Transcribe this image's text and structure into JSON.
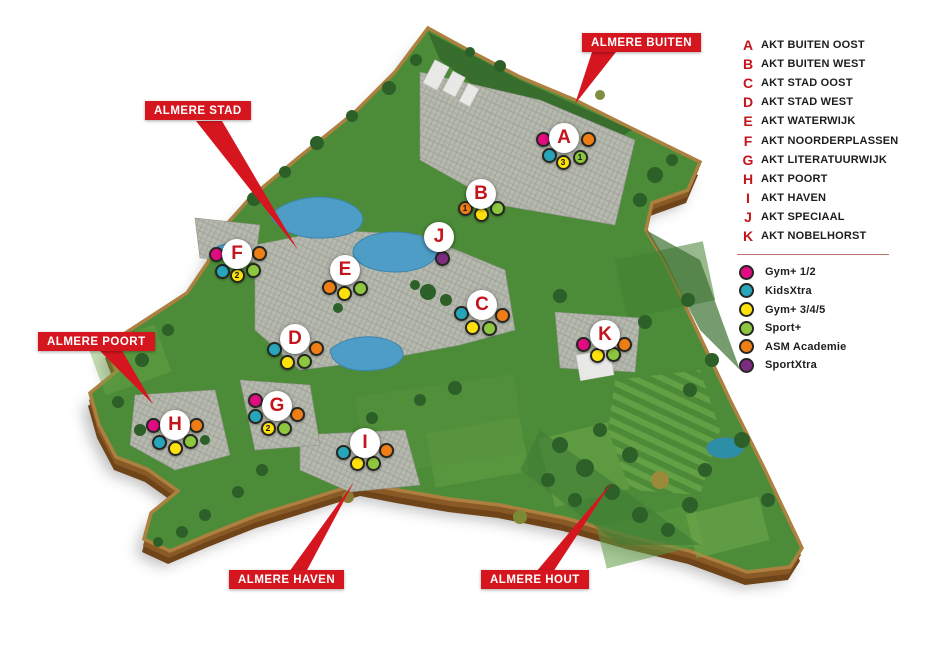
{
  "legend": {
    "districts": [
      {
        "letter": "A",
        "label": "AKT BUITEN OOST"
      },
      {
        "letter": "B",
        "label": "AKT BUITEN WEST"
      },
      {
        "letter": "C",
        "label": "AKT STAD OOST"
      },
      {
        "letter": "D",
        "label": "AKT STAD WEST"
      },
      {
        "letter": "E",
        "label": "AKT WATERWIJK"
      },
      {
        "letter": "F",
        "label": "AKT NOORDERPLASSEN"
      },
      {
        "letter": "G",
        "label": "AKT LITERATUURWIJK"
      },
      {
        "letter": "H",
        "label": "AKT POORT"
      },
      {
        "letter": "I",
        "label": "AKT HAVEN"
      },
      {
        "letter": "J",
        "label": "AKT SPECIAAL"
      },
      {
        "letter": "K",
        "label": "AKT NOBELHORST"
      }
    ],
    "programs": [
      {
        "key": "magenta",
        "name": "Gym+ 1/2",
        "color": "#e10b82"
      },
      {
        "key": "cyan",
        "name": "KidsXtra",
        "color": "#27a5bb"
      },
      {
        "key": "yellow",
        "name": "Gym+ 3/4/5",
        "color": "#ffe20c"
      },
      {
        "key": "green",
        "name": "Sport+",
        "color": "#8dc63f"
      },
      {
        "key": "orange",
        "name": "ASM Academie",
        "color": "#f07e16"
      },
      {
        "key": "purple",
        "name": "SportXtra",
        "color": "#7d2c82"
      }
    ]
  },
  "area_labels": [
    {
      "id": "buiten",
      "text": "ALMERE BUITEN",
      "x": 582,
      "y": 33
    },
    {
      "id": "stad",
      "text": "ALMERE STAD",
      "x": 145,
      "y": 101
    },
    {
      "id": "poort",
      "text": "ALMERE POORT",
      "x": 38,
      "y": 332
    },
    {
      "id": "haven",
      "text": "ALMERE HAVEN",
      "x": 229,
      "y": 570
    },
    {
      "id": "hout",
      "text": "ALMERE HOUT",
      "x": 481,
      "y": 570
    }
  ],
  "map": {
    "markers": [
      {
        "letter": "A",
        "x": 564,
        "y": 138,
        "dots": [
          {
            "color": "magenta",
            "dx": -21,
            "dy": 1
          },
          {
            "color": "orange",
            "dx": 24,
            "dy": 1
          },
          {
            "color": "cyan",
            "dx": -15,
            "dy": 17
          },
          {
            "color": "yellow",
            "dx": -1,
            "dy": 24,
            "num": "3"
          },
          {
            "color": "green",
            "dx": 16,
            "dy": 19,
            "num": "1"
          }
        ]
      },
      {
        "letter": "B",
        "x": 481,
        "y": 194,
        "dots": [
          {
            "color": "orange",
            "dx": -16,
            "dy": 14,
            "num": "1"
          },
          {
            "color": "yellow",
            "dx": 0,
            "dy": 20
          },
          {
            "color": "green",
            "dx": 16,
            "dy": 14
          }
        ]
      },
      {
        "letter": "C",
        "x": 482,
        "y": 305,
        "dots": [
          {
            "color": "cyan",
            "dx": -21,
            "dy": 8
          },
          {
            "color": "orange",
            "dx": 20,
            "dy": 10
          },
          {
            "color": "yellow",
            "dx": -10,
            "dy": 22
          },
          {
            "color": "green",
            "dx": 7,
            "dy": 23
          }
        ]
      },
      {
        "letter": "D",
        "x": 295,
        "y": 339,
        "dots": [
          {
            "color": "cyan",
            "dx": -21,
            "dy": 10
          },
          {
            "color": "orange",
            "dx": 21,
            "dy": 9
          },
          {
            "color": "yellow",
            "dx": -8,
            "dy": 23
          },
          {
            "color": "green",
            "dx": 9,
            "dy": 22
          }
        ]
      },
      {
        "letter": "E",
        "x": 345,
        "y": 270,
        "dots": [
          {
            "color": "orange",
            "dx": -16,
            "dy": 17
          },
          {
            "color": "yellow",
            "dx": -1,
            "dy": 23
          },
          {
            "color": "green",
            "dx": 15,
            "dy": 18
          }
        ]
      },
      {
        "letter": "F",
        "x": 237,
        "y": 254,
        "dots": [
          {
            "color": "magenta",
            "dx": -21,
            "dy": 0
          },
          {
            "color": "orange",
            "dx": 22,
            "dy": -1
          },
          {
            "color": "cyan",
            "dx": -15,
            "dy": 17
          },
          {
            "color": "yellow",
            "dx": 0,
            "dy": 21,
            "num": "2"
          },
          {
            "color": "green",
            "dx": 16,
            "dy": 16
          }
        ]
      },
      {
        "letter": "G",
        "x": 277,
        "y": 406,
        "dots": [
          {
            "color": "magenta",
            "dx": -22,
            "dy": -6
          },
          {
            "color": "cyan",
            "dx": -22,
            "dy": 10
          },
          {
            "color": "orange",
            "dx": 20,
            "dy": 8
          },
          {
            "color": "yellow",
            "dx": -9,
            "dy": 22,
            "num": "2"
          },
          {
            "color": "green",
            "dx": 7,
            "dy": 22
          }
        ]
      },
      {
        "letter": "H",
        "x": 175,
        "y": 425,
        "dots": [
          {
            "color": "magenta",
            "dx": -22,
            "dy": 0
          },
          {
            "color": "orange",
            "dx": 21,
            "dy": 0
          },
          {
            "color": "cyan",
            "dx": -16,
            "dy": 17
          },
          {
            "color": "yellow",
            "dx": 0,
            "dy": 23
          },
          {
            "color": "green",
            "dx": 15,
            "dy": 16
          }
        ]
      },
      {
        "letter": "I",
        "x": 365,
        "y": 443,
        "dots": [
          {
            "color": "cyan",
            "dx": -22,
            "dy": 9
          },
          {
            "color": "orange",
            "dx": 21,
            "dy": 7
          },
          {
            "color": "yellow",
            "dx": -8,
            "dy": 20
          },
          {
            "color": "green",
            "dx": 8,
            "dy": 20
          }
        ]
      },
      {
        "letter": "J",
        "x": 439,
        "y": 237,
        "dots": [
          {
            "color": "purple",
            "dx": 3,
            "dy": 21
          }
        ]
      },
      {
        "letter": "K",
        "x": 605,
        "y": 335,
        "dots": [
          {
            "color": "magenta",
            "dx": -22,
            "dy": 9
          },
          {
            "color": "orange",
            "dx": 19,
            "dy": 9
          },
          {
            "color": "yellow",
            "dx": -8,
            "dy": 20
          },
          {
            "color": "green",
            "dx": 8,
            "dy": 19
          }
        ]
      }
    ]
  },
  "colors": {
    "label_red": "#d5161f",
    "legend_letter_red": "#c3161c",
    "grass_green": "#4c8c39",
    "water_blue": "#4d9dc7"
  }
}
